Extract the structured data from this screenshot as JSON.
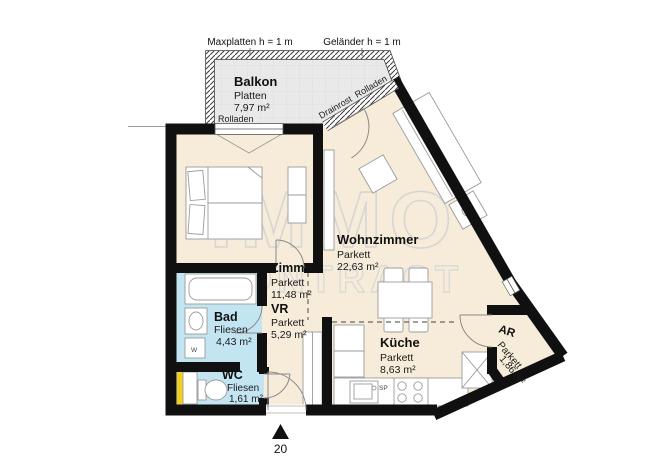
{
  "plan": {
    "watermark_line1": "IMMO",
    "watermark_line2": "CONTRACT",
    "plan_number": "20"
  },
  "balcony": {
    "name": "Balkon",
    "floor": "Platten",
    "area": "7,97 m²"
  },
  "rooms": [
    {
      "id": "wohnzimmer",
      "name": "Wohnzimmer",
      "floor": "Parkett",
      "area": "22,63 m²"
    },
    {
      "id": "zimmer",
      "name": "Zimmer",
      "floor": "Parkett",
      "area": "11,48 m²"
    },
    {
      "id": "vr",
      "name": "VR",
      "floor": "Parkett",
      "area": "5,29 m²"
    },
    {
      "id": "bad",
      "name": "Bad",
      "floor": "Fliesen",
      "area": "4,43 m²"
    },
    {
      "id": "wc",
      "name": "WC",
      "floor": "Fliesen",
      "area": "1,61 m²"
    },
    {
      "id": "kueche",
      "name": "Küche",
      "floor": "Parkett",
      "area": "8,63 m²"
    },
    {
      "id": "ar",
      "name": "AR",
      "floor": "Parkett",
      "area": "1,86 m²"
    }
  ],
  "annotations": {
    "dim_left": "Maxplatten h = 1 m",
    "dim_right": "Geländer h = 1 m",
    "rolladen_balcony": "Rolladen",
    "rolladen_diagonal": "Rolladen",
    "drainrost": "Drainrost",
    "sink_label": "SP",
    "washer_label": "W"
  },
  "colors": {
    "wall": "#101010",
    "floor_cream": "#f6ecd9",
    "wet_room_blue": "#c3e5f2",
    "balcony_gray": "#e9e9e9",
    "shaft_yellow": "#f2cf1d",
    "watermark_gray": "#d6d6d6"
  }
}
